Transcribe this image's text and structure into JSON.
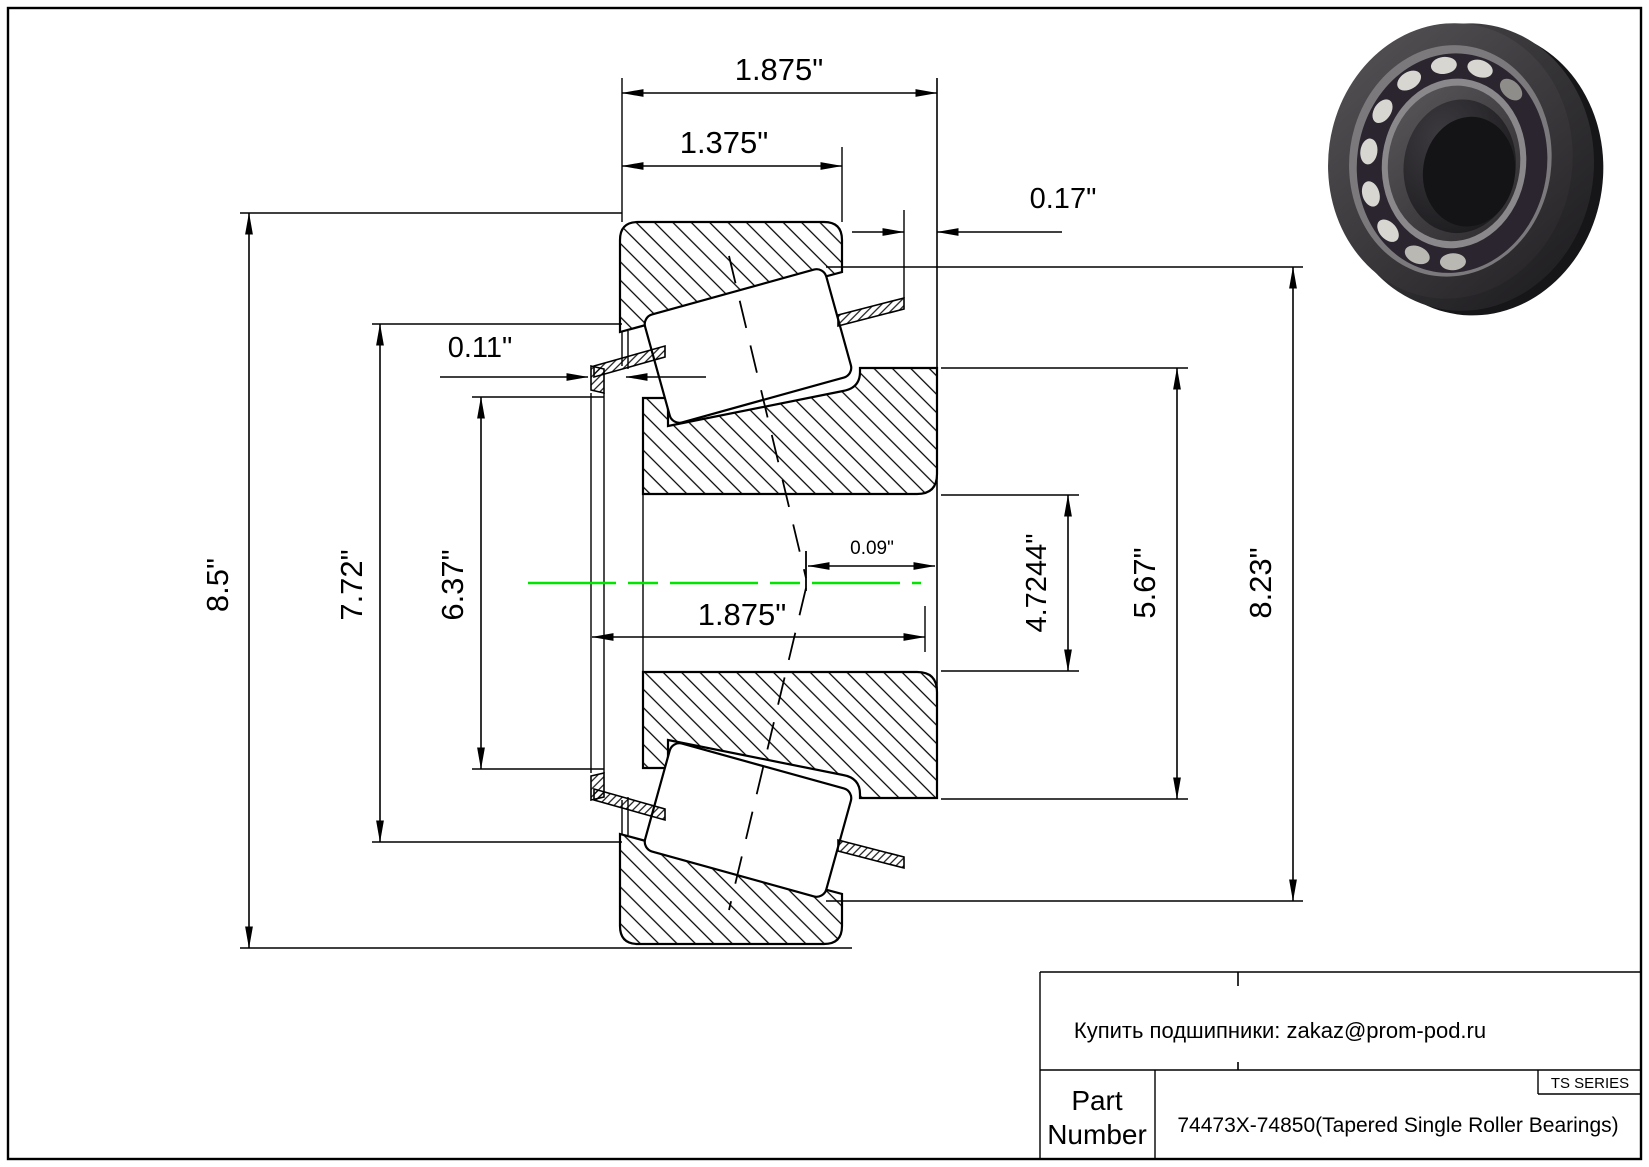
{
  "drawing": {
    "centerline_color": "#00e400",
    "dimensions": [
      {
        "name": "overall-width-top",
        "label": "1.875\""
      },
      {
        "name": "cup-width",
        "label": "1.375\""
      },
      {
        "name": "cage-standout",
        "label": "0.17\""
      },
      {
        "name": "cage-lip-offset",
        "label": "0.11\""
      },
      {
        "name": "outer-diameter",
        "label": "8.5\""
      },
      {
        "name": "cup-back-diameter",
        "label": "7.72\""
      },
      {
        "name": "cone-front-diameter",
        "label": "6.37\""
      },
      {
        "name": "effective-center-offset",
        "label": "0.09\""
      },
      {
        "name": "cone-width",
        "label": "1.875\""
      },
      {
        "name": "bore-diameter",
        "label": "4.7244\""
      },
      {
        "name": "cone-back-diameter",
        "label": "5.67\""
      },
      {
        "name": "roller-tip-diameter",
        "label": "8.23\""
      }
    ]
  },
  "title_block": {
    "supplier_note": "Купить подшипники: zakaz@prom-pod.ru",
    "series_badge": "TS SERIES",
    "part_label_line1": "Part",
    "part_label_line2": "Number",
    "part_number": "74473X-74850(Tapered Single Roller Bearings)"
  },
  "illustration": {
    "alt": "tapered-single-roller-bearing-3d-render"
  }
}
